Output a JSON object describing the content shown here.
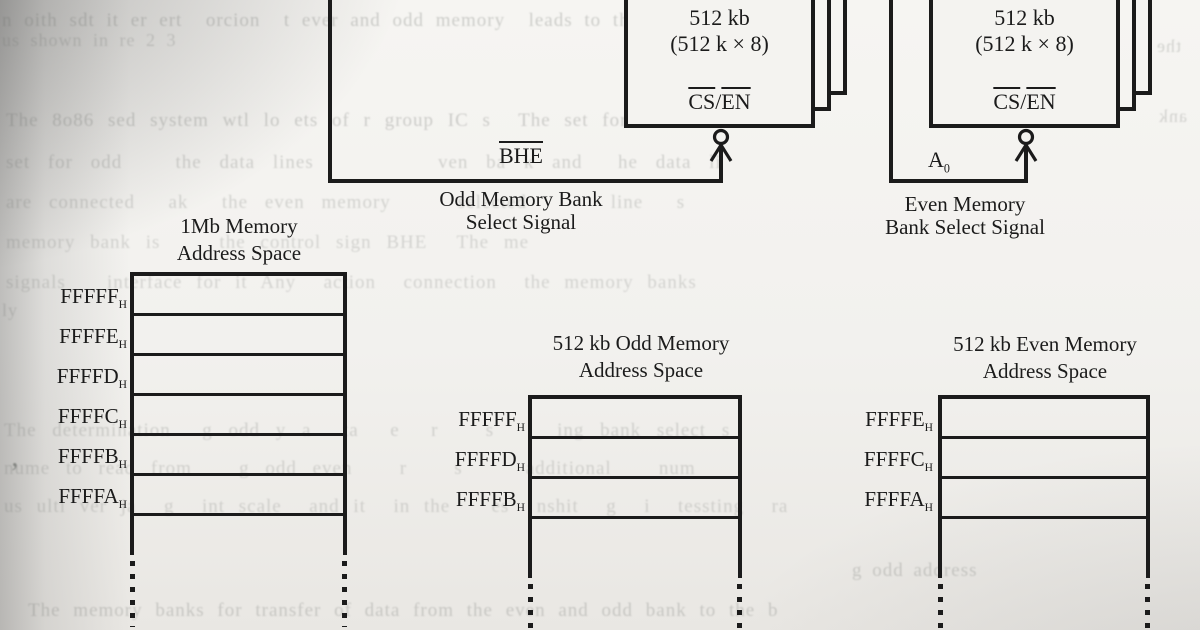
{
  "chips": {
    "odd": {
      "capacity": "512 kb",
      "organization": "(512 k × 8)",
      "pin": {
        "left": "CS",
        "separator": "/",
        "right": "EN"
      },
      "select_signal": "BHE",
      "caption_line1": "Odd Memory Bank",
      "caption_line2": "Select Signal"
    },
    "even": {
      "capacity": "512 kb",
      "organization": "(512 k × 8)",
      "pin": {
        "left": "CS",
        "separator": "/",
        "right": "EN"
      },
      "select_signal_base": "A",
      "select_signal_sub": "0",
      "caption_line1": "Even Memory",
      "caption_line2": "Bank Select Signal"
    }
  },
  "tables": {
    "mem1mb": {
      "title_line1": "1Mb Memory",
      "title_line2": "Address Space",
      "subscript": "H",
      "addresses": [
        "FFFFF",
        "FFFFE",
        "FFFFD",
        "FFFFC",
        "FFFFB",
        "FFFFA"
      ]
    },
    "odd512": {
      "title_line1": "512 kb Odd Memory",
      "title_line2": "Address Space",
      "subscript": "H",
      "addresses": [
        "FFFFF",
        "FFFFD",
        "FFFFB"
      ]
    },
    "even512": {
      "title_line1": "512 kb Even Memory",
      "title_line2": "Address Space",
      "subscript": "H",
      "addresses": [
        "FFFFE",
        "FFFFC",
        "FFFFA"
      ]
    }
  },
  "colors": {
    "ink": "#1b1b1b",
    "paper": "#f2f1ee",
    "bleed_text": "#6f726e"
  },
  "bleedthrough": [
    {
      "text": "n oith sdt it er ert  orcion  t ever and odd memory  leads to the alloc",
      "x": 2,
      "y": 10,
      "size": 19,
      "o": 0.3,
      "ws": 6
    },
    {
      "text": "us shown in re 2 3",
      "x": 2,
      "y": 30,
      "size": 18,
      "o": 0.26,
      "ws": 5
    },
    {
      "text": "The 8o86 sed system wtl lo ets of r group IC s  The set for even bank",
      "x": 6,
      "y": 110,
      "size": 19,
      "o": 0.3,
      "ws": 8
    },
    {
      "text": "set for odd   the data lines       ven ba k and  he data li",
      "x": 6,
      "y": 152,
      "size": 19,
      "o": 0.27,
      "ws": 12
    },
    {
      "text": "are connected  ak  the even memory    selected     line  s",
      "x": 6,
      "y": 192,
      "size": 19,
      "o": 0.25,
      "ws": 11
    },
    {
      "text": "memory bank is    the control sign BHE  The me",
      "x": 6,
      "y": 232,
      "size": 19,
      "o": 0.24,
      "ws": 9
    },
    {
      "text": "signals   interface for it Any  action  connection  the memory banks",
      "x": 6,
      "y": 272,
      "size": 19,
      "o": 0.24,
      "ws": 8
    },
    {
      "text": "The determination  g odd y a  ta  e  r   s    ing bank select s",
      "x": 4,
      "y": 420,
      "size": 19,
      "o": 0.25,
      "ws": 10
    },
    {
      "text": "nume to read from   g odd even   r   s    additional   num",
      "x": 4,
      "y": 458,
      "size": 19,
      "o": 0.24,
      "ws": 10
    },
    {
      "text": "us ulti ver ja  g  int scale  and it  in the   es  nshit  g  i  tessting  ra",
      "x": 4,
      "y": 496,
      "size": 19,
      "o": 0.24,
      "ws": 8
    },
    {
      "text": "g odd address",
      "x": 852,
      "y": 560,
      "size": 19,
      "o": 0.28,
      "ws": 4
    },
    {
      "text": "The memory banks for transfer of data from the even and odd bank to the b",
      "x": 28,
      "y": 600,
      "size": 19,
      "o": 0.28,
      "ws": 7
    },
    {
      "text": "’",
      "x": 10,
      "y": 458,
      "size": 28,
      "o": 0.75
    },
    {
      "text": "the",
      "x": 1156,
      "y": 36,
      "size": 18,
      "o": 0.26,
      "mirror": true
    },
    {
      "text": "ank",
      "x": 1158,
      "y": 106,
      "size": 18,
      "o": 0.26,
      "mirror": true
    },
    {
      "text": "ly",
      "x": 2,
      "y": 300,
      "size": 18,
      "o": 0.26
    }
  ]
}
